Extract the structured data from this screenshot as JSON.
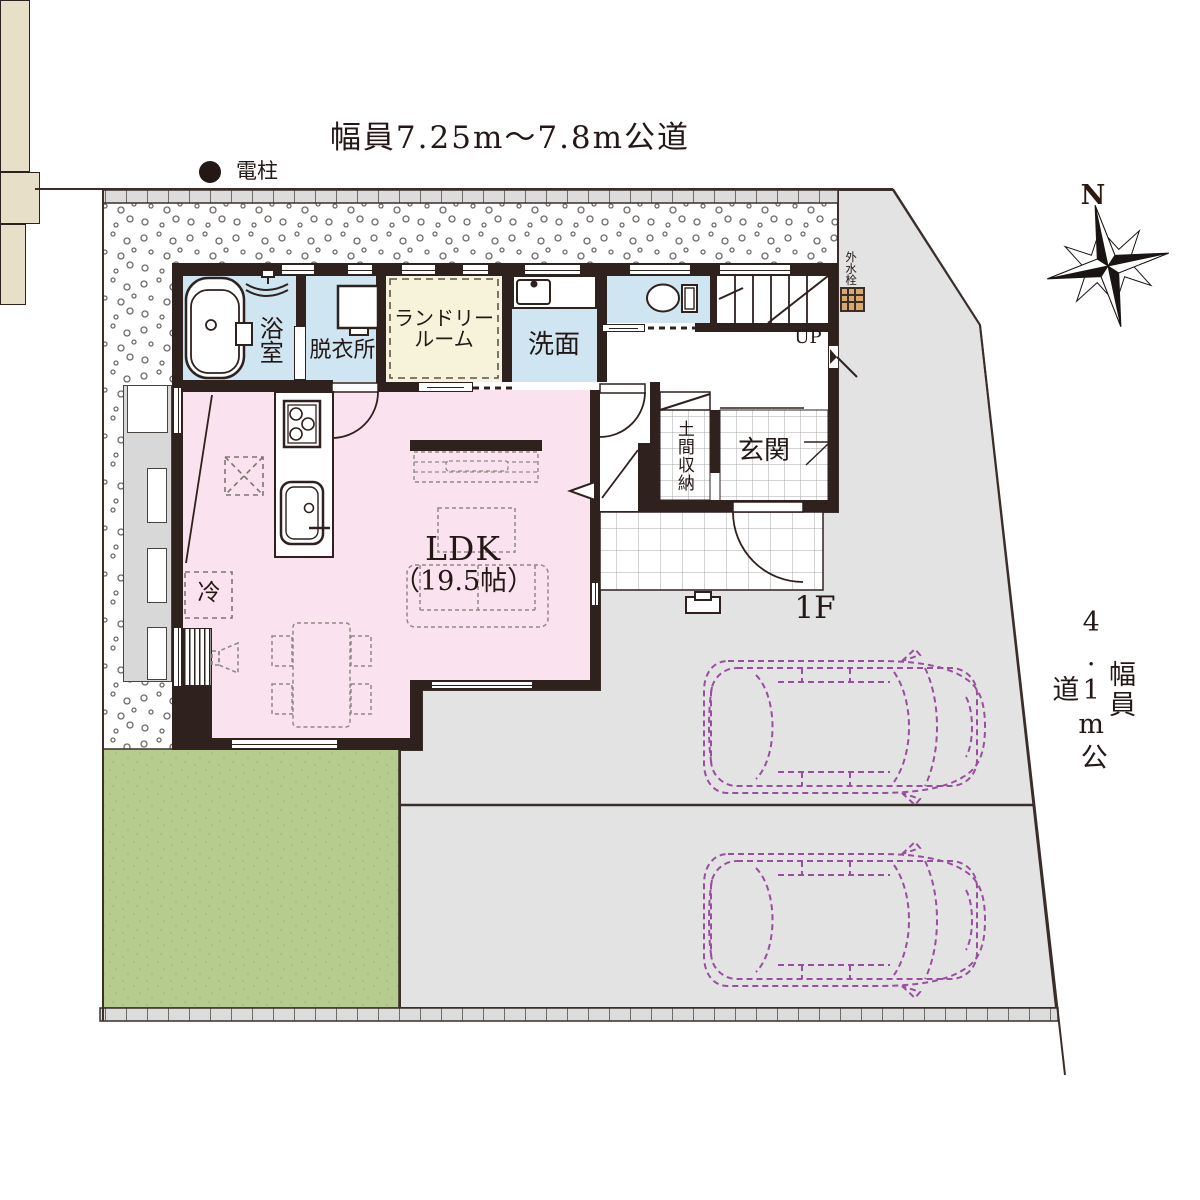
{
  "header": {
    "road_top": "幅員7.25m～7.8m公道"
  },
  "site": {
    "utility_pole": "電柱",
    "road_right": "幅員4.1m公道",
    "floor_label": "1F",
    "compass_n": "N",
    "outdoor_faucet": "外水栓"
  },
  "rooms": {
    "bath": "浴室",
    "dressing": "脱衣所",
    "laundry_line1": "ランドリー",
    "laundry_line2": "ルーム",
    "washroom": "洗面",
    "stairs_up": "UP",
    "doma_storage": "土間収納",
    "entrance": "玄関",
    "ldk": "LDK",
    "ldk_size": "（19.5帖）",
    "fridge": "冷"
  },
  "colors": {
    "wall": "#2e211e",
    "ldk_pink": "#fae3ee",
    "wet_area_blue": "#cfe5f2",
    "laundry_cream": "#f7f3da",
    "storage_beige": "#e7dfc8",
    "driveway_grey": "#e3e3e4",
    "lawn_green": "#b6cc8f",
    "car_outline_purple": "#994f9f"
  }
}
